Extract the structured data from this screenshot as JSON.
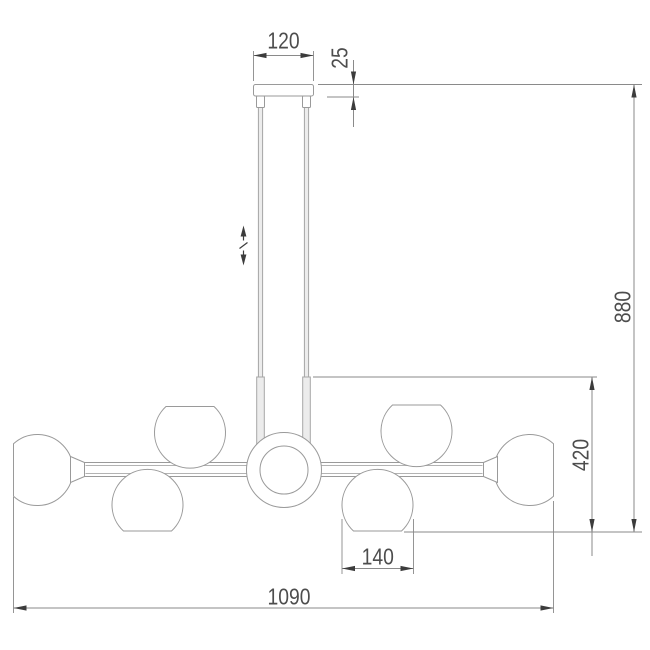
{
  "drawing": {
    "type": "technical-dimension-drawing",
    "subject": "chandelier side elevation",
    "dims": {
      "canopy_width": "120",
      "canopy_height": "25",
      "overall_drop": "880",
      "fixture_height": "420",
      "shade_diameter": "140",
      "overall_width": "1090"
    },
    "icons": {
      "height_adjust": "double-vertical-arrow-with-slash"
    },
    "colors": {
      "background": "#ffffff",
      "outline": "#9a9a9a",
      "rod_fill": "#ececec",
      "rod_stroke": "#a6a6a6",
      "dim_line": "#8a8a8a",
      "arrow": "#3c3c3c",
      "text": "#4d4d4d"
    }
  }
}
